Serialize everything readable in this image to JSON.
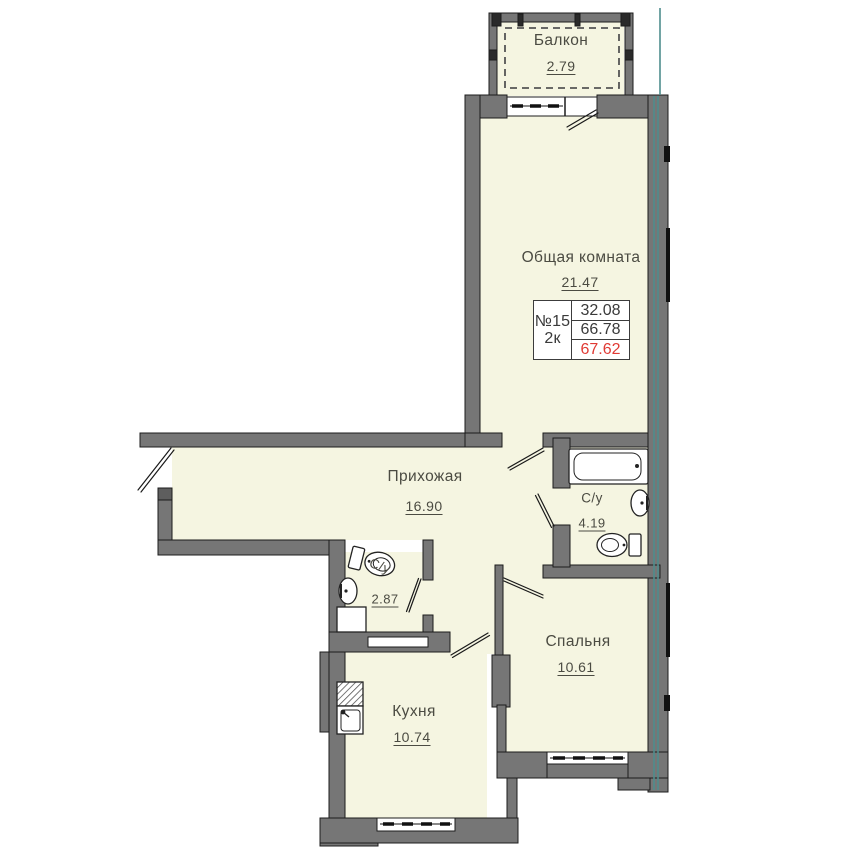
{
  "unit": {
    "number": "№15",
    "rooms_type": "2к",
    "areas": {
      "living": "32.08",
      "total": "66.78",
      "total_with_balcony": "67.62"
    }
  },
  "rooms": {
    "balcony": {
      "label": "Балкон",
      "area": "2.79"
    },
    "living_room": {
      "label": "Общая комната",
      "area": "21.47"
    },
    "hallway": {
      "label": "Прихожая",
      "area": "16.90"
    },
    "bathroom_main": {
      "label": "С/у",
      "area": "4.19"
    },
    "bathroom_small": {
      "label": "С/у",
      "area": "2.87"
    },
    "bedroom": {
      "label": "Спальня",
      "area": "10.61"
    },
    "kitchen": {
      "label": "Кухня",
      "area": "10.74"
    }
  },
  "fixtures": {
    "bathtub": "bathtub-icon",
    "toilet": "toilet-icon",
    "sink": "sink-icon",
    "stove": "stove-hatch-icon",
    "cabinet": "cabinet-icon"
  },
  "colors": {
    "room_fill": "#f5f5e1",
    "wall": "#767676",
    "outline": "#1c1c1c",
    "glazing_accent": "#4f8d8d",
    "total_area_highlight": "#e03a34",
    "label_text": "#4b4b42"
  }
}
